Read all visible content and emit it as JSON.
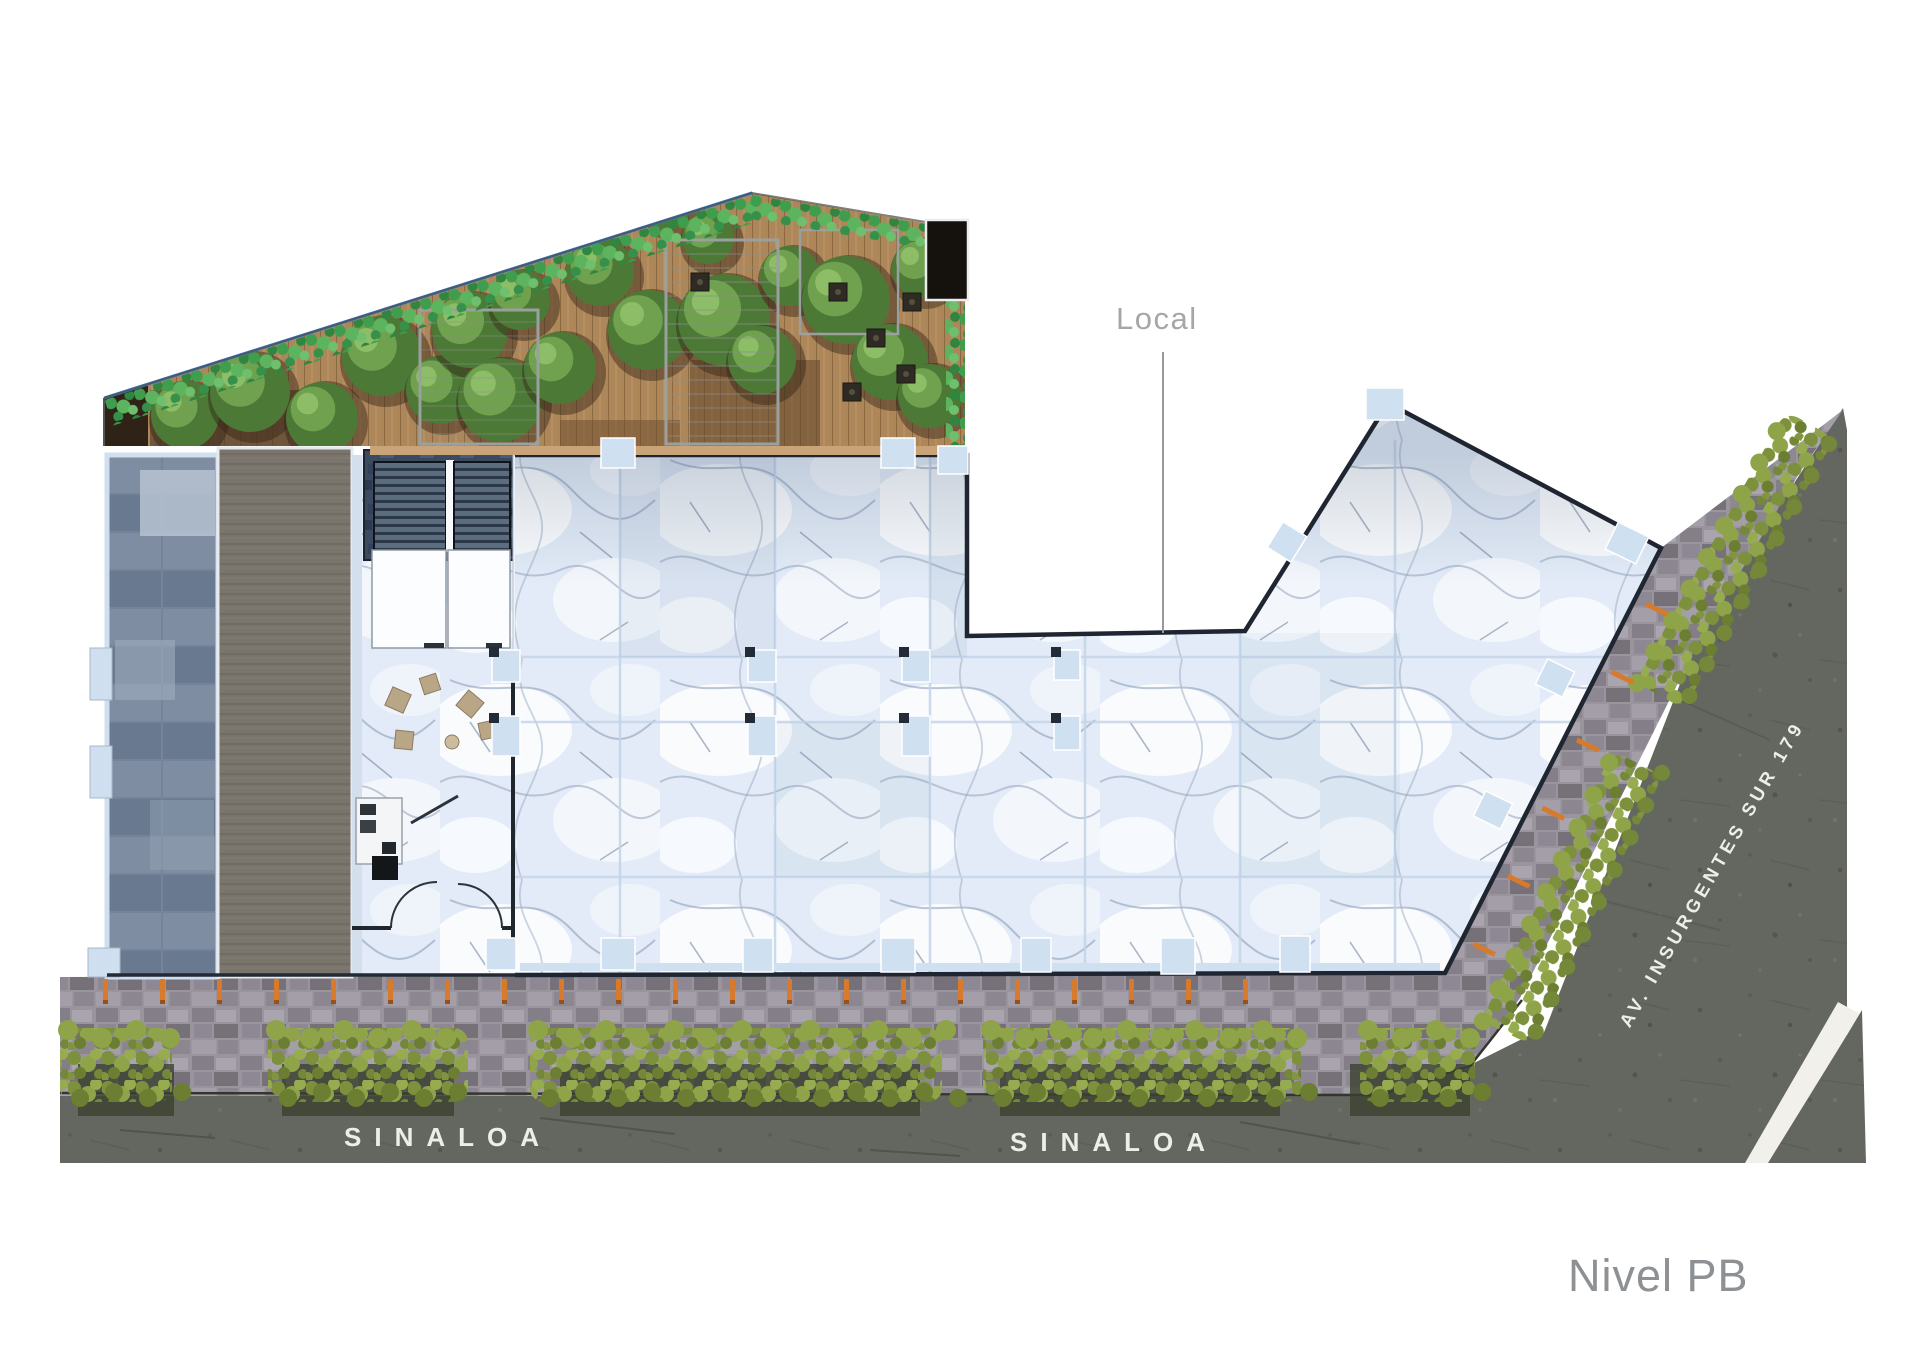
{
  "labels": {
    "local": "Local",
    "sinaloa_west": "SINALOA",
    "sinaloa_east": "SINALOA",
    "avenue": "AV. INSURGENTES SUR 179",
    "level": "Nivel PB"
  },
  "colors": {
    "marble_floor": "#e2ebf7",
    "wall_outline": "#1f2631",
    "column_marker": "#cfe0f1",
    "accent_orange": "#d77a2c",
    "hedge_green": "#8a9d43",
    "terrace_green": "#4c9e52",
    "deck_wood": "#ad8759",
    "sidewalk_paver": "#9a959d",
    "asphalt": "#64675f",
    "street_text": "#edeee9",
    "annotation_gray": "#a4a6a8"
  }
}
